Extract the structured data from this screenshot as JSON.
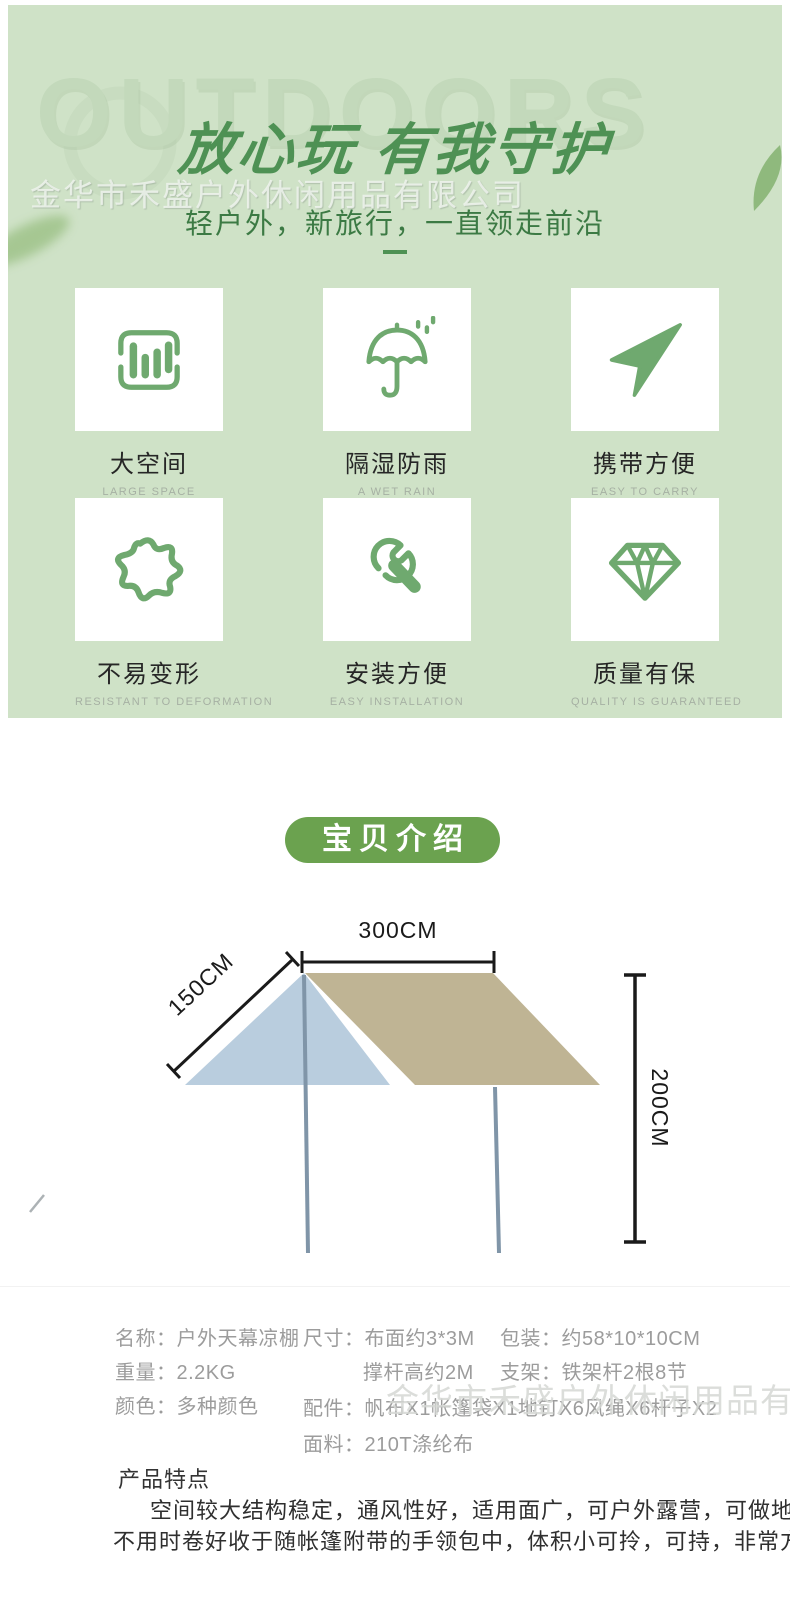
{
  "company_watermark": "金华市禾盛户外休闲用品有限公司",
  "hero": {
    "outdoors_watermark": "OUTDOORS",
    "title": "放心玩 有我守护",
    "subtitle": "轻户外，新旅行，一直领走前沿",
    "colors": {
      "background": "#cfe2c7",
      "title_green": "#4e9154",
      "subtitle_green": "#3c7a44",
      "icon_green": "#6fa96f"
    }
  },
  "features": [
    {
      "title": "大空间",
      "subtitle": "LARGE SPACE",
      "icon": "bar-chart-icon"
    },
    {
      "title": "隔湿防雨",
      "subtitle": "A WET RAIN",
      "icon": "umbrella-icon"
    },
    {
      "title": "携带方便",
      "subtitle": "EASY TO CARRY",
      "icon": "navigation-arrow-icon"
    },
    {
      "title": "不易变形",
      "subtitle": "RESISTANT TO DEFORMATION",
      "icon": "blob-icon"
    },
    {
      "title": "安装方便",
      "subtitle": "EASY INSTALLATION",
      "icon": "wrench-icon"
    },
    {
      "title": "质量有保",
      "subtitle": "QUALITY IS GUARANTEED",
      "icon": "diamond-icon"
    }
  ],
  "intro_button": {
    "label": "宝贝介绍",
    "background": "#6ba24f"
  },
  "diagram": {
    "width_label": "300CM",
    "slope_label": "150CM",
    "height_label": "200CM",
    "colors": {
      "canopy_left": "#b9cdde",
      "canopy_right": "#bfb494",
      "pole": "#8095a8",
      "dimension": "#1a1a1a"
    }
  },
  "specs": {
    "col1": [
      "名称：户外天幕凉棚",
      "重量：2.2KG",
      "颜色：多种颜色"
    ],
    "col2": [
      "尺寸：布面约3*3M",
      "撑杆高约2M",
      "配件：帆布X1帐篷袋X1地钉X6风绳X6杆子X2",
      "面料：210T涤纶布"
    ],
    "col3": [
      "包装：约58*10*10CM",
      "支架：铁架杆2根8节"
    ]
  },
  "product_features": {
    "heading": "产品特点",
    "line1": "空间较大结构稳定，通风性好，适用面广，可户外露营，可做地席!",
    "line2": "不用时卷好收于随帐篷附带的手领包中，体积小可拎，可持，非常方便"
  }
}
